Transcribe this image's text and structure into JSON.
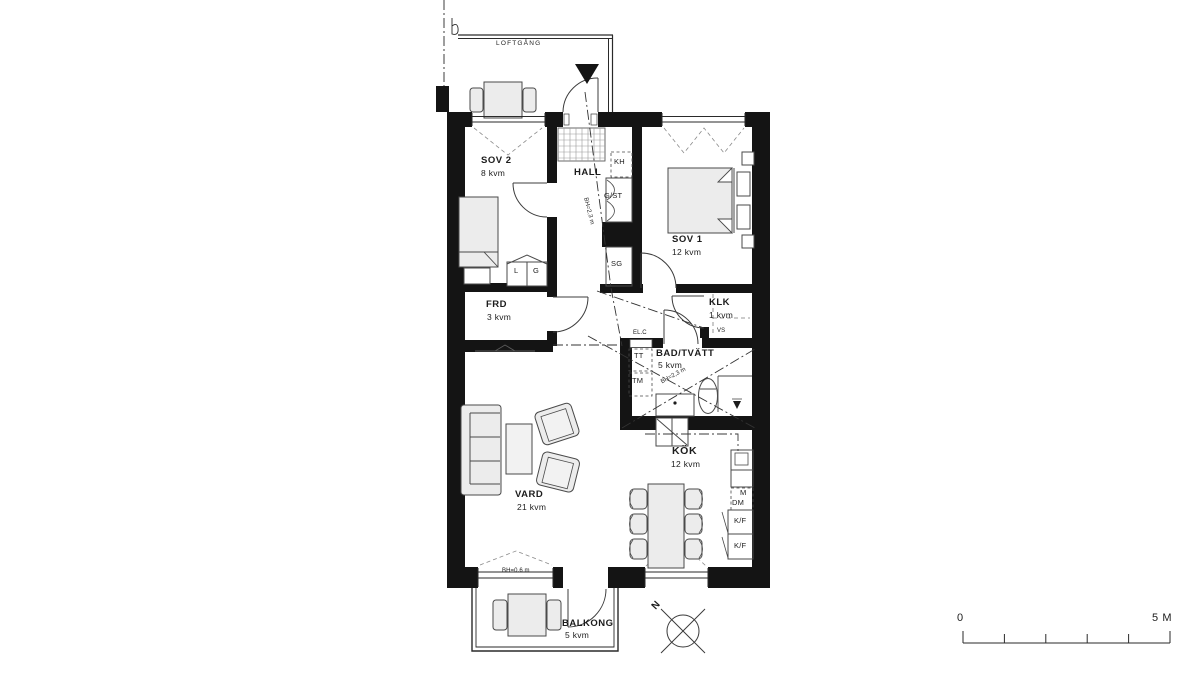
{
  "plan": {
    "walkway_label": "LOFTGÅNG",
    "rooms": {
      "sov2": {
        "name": "SOV 2",
        "area": "8 kvm"
      },
      "hall": {
        "name": "HALL"
      },
      "sov1": {
        "name": "SOV 1",
        "area": "12 kvm"
      },
      "frd": {
        "name": "FRD",
        "area": "3 kvm"
      },
      "klk": {
        "name": "KLK",
        "area": "1 kvm"
      },
      "bad_tvatt": {
        "name": "BAD/TVÄTT",
        "area": "5 kvm"
      },
      "vard": {
        "name": "VARD",
        "area": "21 kvm"
      },
      "kok": {
        "name": "KÖK",
        "area": "12 kvm"
      },
      "balkong": {
        "name": "BALKONG",
        "area": "5 kvm"
      }
    },
    "closets": {
      "kh": "KH",
      "g_st": "G/ST",
      "sg": "SG",
      "l": "L",
      "g": "G"
    },
    "appliances": {
      "tt": "TT",
      "tm": "TM",
      "m": "M",
      "dm": "DM",
      "kf_top": "K/F",
      "kf_bottom": "K/F"
    },
    "technical": {
      "el_c": "EL.C",
      "vs": "VS"
    },
    "ceiling_heights": {
      "hall_line": "BH=2,3 m",
      "bad_line": "BH=2,3 m",
      "window_sill": "BH=0.6 m"
    },
    "compass_north": "N",
    "scale_bar": {
      "start": "0",
      "end": "5 M"
    }
  },
  "colors": {
    "wall": "#141414",
    "line": "#4a4a4a",
    "furniture_fill": "#ececec",
    "text": "#1c1c1c",
    "background": "#ffffff"
  }
}
